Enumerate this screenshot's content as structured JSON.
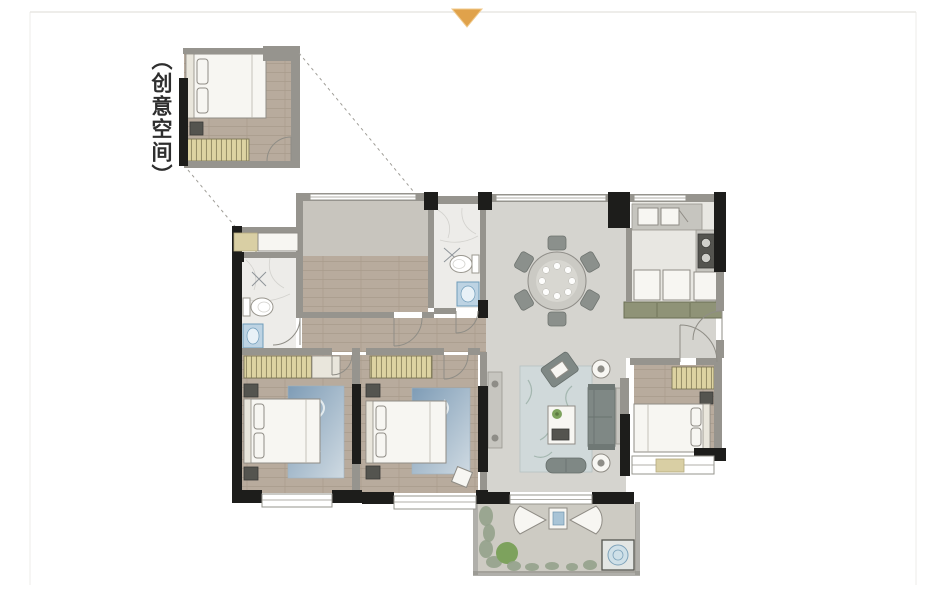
{
  "annotation": {
    "label": "（创意空间）"
  },
  "marker": {
    "shape": "triangle-down"
  },
  "colors": {
    "marker": "#e0a24b",
    "frame": "#e9e7e3",
    "wallDark": "#1d1d1b",
    "wallGray": "#96948e",
    "floorWood": "#b8ab9d",
    "floorWoodLine": "#a69888",
    "floorTile": "#d5d4cf",
    "floorConcrete": "#c8c5be",
    "floorMarble": "#edece9",
    "floorKitchen": "#e8e7e2",
    "floorBalcony": "#cdcbc3",
    "wardrobeFill": "#ddd3a2",
    "wardrobeLine": "#8c845f",
    "rugBlueA": "#7e9cb6",
    "rugBlueB": "#cfdae2",
    "rugLiving": "#d0d9da",
    "sofa": "#7f8885",
    "furnWhite": "#f7f6f2",
    "furnLine": "#8f8c85",
    "tan": "#d9cfa4",
    "sinkFill": "#bdd3e3",
    "sinkLine": "#6f9cba",
    "cabinetGreen": "#8f9377",
    "plant": "#7da25d",
    "foliage": "#95a28c",
    "label": "#2e2e2e"
  }
}
